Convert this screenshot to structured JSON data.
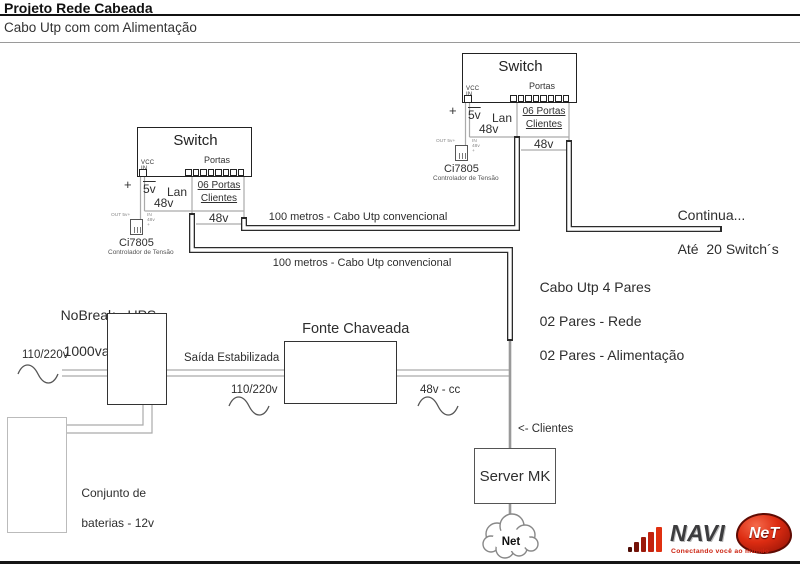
{
  "header": {
    "title": "Projeto Rede Cabeada",
    "subtitle": "Cabo Utp com com Alimentação"
  },
  "switch_unit": {
    "title": "Switch",
    "vcc_in": "VCC IN",
    "portas": "Portas",
    "plus": "+",
    "v5": "5v",
    "lan": "Lan",
    "ports_clients_line1": "06 Portas",
    "ports_clients_line2": "Clientes",
    "v48_a": "48v",
    "v48_b": "48v",
    "out_5v": "OUT 5v+",
    "in_48v": "IN 48v +",
    "ci_name": "Ci7805",
    "ci_desc": "Controlador de Tensão"
  },
  "cabling": {
    "run1_label": "100 metros - Cabo Utp convencional",
    "run2_label": "100 metros - Cabo Utp convencional",
    "continua_line1": "Continua...",
    "continua_line2": "Até  20 Switch´s",
    "utp_line1": "Cabo Utp 4 Pares",
    "utp_line2": "02 Pares - Rede",
    "utp_line3": "02 Pares - Alimentação"
  },
  "power": {
    "nobreak_line1": "NoBreak - UPS",
    "nobreak_line2": "1000va",
    "ac_input": "110/220v",
    "saida": "Saída Estabilizada",
    "ac_mid": "110/220v",
    "fonte_line1": "Fonte Chaveada",
    "fonte_line2": "48V/15A",
    "dc_out": "48v - cc",
    "battery_line1": "Conjunto de",
    "battery_line2": "baterias - 12v"
  },
  "server": {
    "clientes": "<- Clientes",
    "name": "Server MK",
    "cloud": "Net"
  },
  "logo": {
    "navi": "NAVI",
    "net": "NeT",
    "tagline": "Conectando você ao mundo"
  },
  "colors": {
    "cable_outline": "#2b2b2b",
    "thin_wire": "#aaaaaa",
    "server_wire": "#999999",
    "logo_red": "#dd2c12"
  }
}
